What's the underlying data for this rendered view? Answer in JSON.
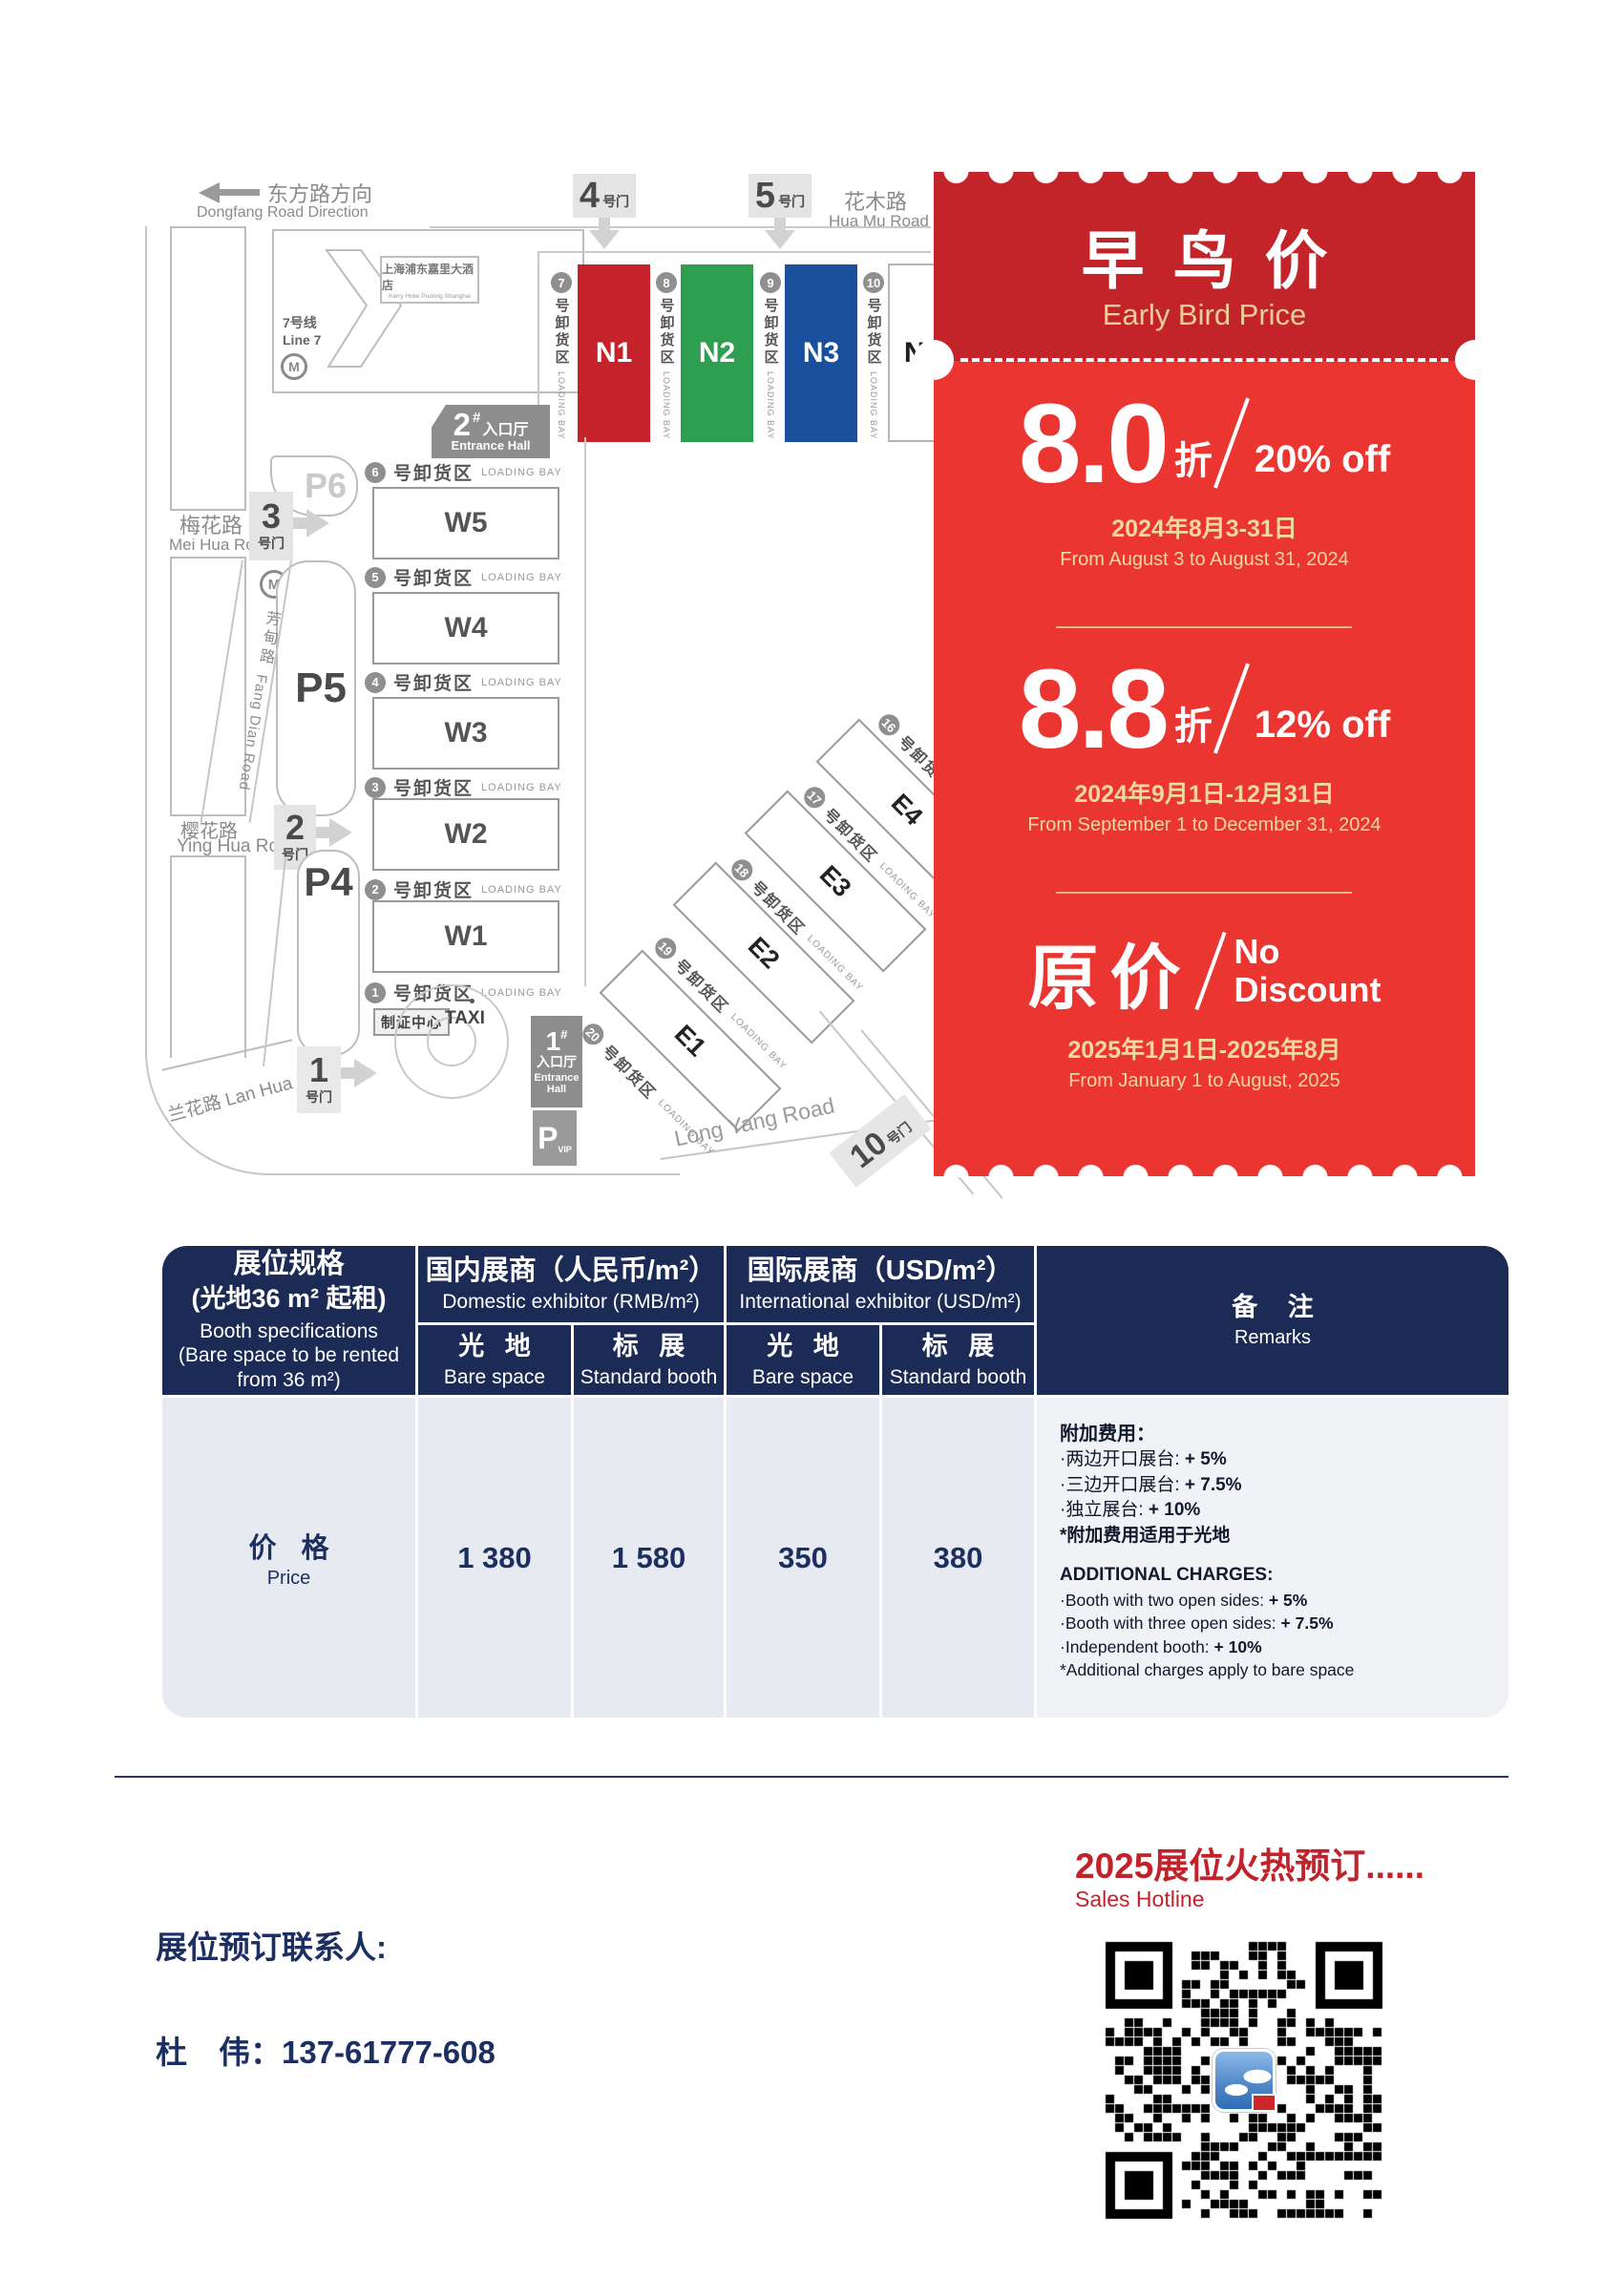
{
  "colors": {
    "ticket_dark_red": "#c2242a",
    "ticket_bright_red": "#ea3530",
    "gold_text": "#e9cf9a",
    "table_navy": "#1b2b55",
    "table_body_bg": "#e7eaf0",
    "price_navy": "#1b3060",
    "accent_red": "#c2232b",
    "hall_n1": "#c5232b",
    "hall_n2": "#2e9e50",
    "hall_n3": "#1a4f9d"
  },
  "map": {
    "dongfang_zh": "东方路方向",
    "dongfang_en": "Dongfang Road Direction",
    "hotel_zh": "上海浦东嘉里大酒店",
    "hotel_en": "Kerry Hotel Pudong Shanghai",
    "line7_zh": "7号线",
    "line7_en": "Line 7",
    "metro_m": "M",
    "huamu_zh": "花木路",
    "huamu_en": "Hua Mu Road",
    "meihua_zh": "梅花路",
    "meihua_en": "Mei Hua Road",
    "fangdian_zh": "芳甸路",
    "fangdian_en": "Fang Dian Road",
    "yinghua_zh": "樱花路",
    "yinghua_en": "Ying Hua Road",
    "lanhua_zh": "兰花路",
    "lanhua_en": "Lan Hua Road",
    "longyang_en": "Long Yang Road",
    "gate_suffix": "号门",
    "gates": {
      "g1": "1",
      "g2": "2",
      "g3": "3",
      "g4": "4",
      "g5": "5",
      "g10": "10"
    },
    "parking": {
      "p6": "P6",
      "p5": "P5",
      "p4": "P4",
      "pvip": "P",
      "pvip_sub": "VIP"
    },
    "entrance": {
      "h2": "2",
      "h1": "1",
      "hash": "#",
      "zh": "入口厅",
      "en": "Entrance Hall"
    },
    "badge_center": "制证中心",
    "taxi": "TAXI",
    "bay_zh": "号卸货区",
    "bay_en": "LOADING BAY",
    "halls_n": [
      "N1",
      "N2",
      "N3",
      "N4"
    ],
    "halls_w": [
      "W5",
      "W4",
      "W3",
      "W2",
      "W1"
    ],
    "halls_e": [
      "E4",
      "E3",
      "E2",
      "E1"
    ],
    "bays_n": [
      "7",
      "8",
      "9",
      "10"
    ],
    "bays_w": [
      "6",
      "5",
      "4",
      "3",
      "2",
      "1"
    ],
    "bays_e": [
      "16",
      "17",
      "18",
      "19",
      "20"
    ]
  },
  "ticket": {
    "title_zh": "早鸟价",
    "title_en": "Early Bird Price",
    "t1": {
      "big": "8.0",
      "unit": "折",
      "pct": "20% off",
      "date_zh": "2024年8月3-31日",
      "date_en": "From August 3 to August 31, 2024"
    },
    "t2": {
      "big": "8.8",
      "unit": "折",
      "pct": "12% off",
      "date_zh": "2024年9月1日-12月31日",
      "date_en": "From September 1 to December 31, 2024"
    },
    "t3": {
      "big": "原价",
      "pct1": "No",
      "pct2": "Discount",
      "date_zh": "2025年1月1日-2025年8月",
      "date_en": "From January 1 to August, 2025"
    }
  },
  "table": {
    "spec": {
      "zh1": "展位规格",
      "zh2": "(光地36 m² 起租)",
      "en1": "Booth specifications",
      "en2": "(Bare space to be rented",
      "en3": "from 36 m²)"
    },
    "domestic": {
      "zh": "国内展商（人民币/m²）",
      "en": "Domestic exhibitor (RMB/m²)"
    },
    "international": {
      "zh": "国际展商（USD/m²）",
      "en": "International exhibitor (USD/m²)"
    },
    "remarks_head": {
      "zh": "备 注",
      "en": "Remarks"
    },
    "sub": {
      "bare_zh": "光 地",
      "bare_en": "Bare space",
      "std_zh": "标 展",
      "std_en": "Standard booth"
    },
    "price_row": {
      "zh": "价 格",
      "en": "Price",
      "values": [
        "1 380",
        "1 580",
        "350",
        "380"
      ]
    },
    "remarks_body": {
      "zh_title": "附加费用：",
      "zh_lines": [
        [
          "·两边开口展台: ",
          "+ 5%"
        ],
        [
          "·三边开口展台: ",
          "+ 7.5%"
        ],
        [
          "·独立展台: ",
          "+ 10%"
        ]
      ],
      "zh_note": "*附加费用适用于光地",
      "en_title": "ADDITIONAL CHARGES:",
      "en_lines": [
        [
          "·Booth with two open sides: ",
          "+ 5%"
        ],
        [
          "·Booth with three open sides: ",
          "+ 7.5%"
        ],
        [
          "·Independent booth: ",
          "+ 10%"
        ]
      ],
      "en_note": "*Additional charges apply to bare space"
    }
  },
  "footer": {
    "hotline_zh": "2025展位火热预订......",
    "hotline_en": "Sales Hotline",
    "contact_label": "展位预订联系人:",
    "contact": "杜　伟：137-61777-608"
  }
}
